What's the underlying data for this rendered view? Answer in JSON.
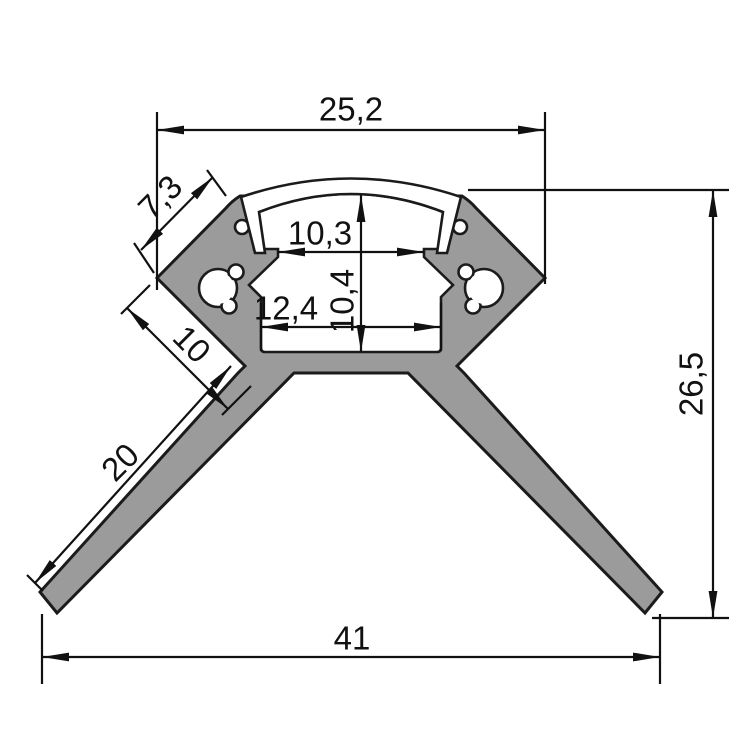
{
  "drawing": {
    "kind": "technical-cross-section",
    "subject": "corner LED aluminium profile with diffuser lens",
    "dimensions": {
      "top_width": "25,2",
      "upper_left_face": "7,3",
      "opening_width": "10,3",
      "channel_height": "10,4",
      "channel_width": "12,4",
      "lower_left_face": "10",
      "flange_length": "20",
      "overall_height": "26,5",
      "overall_width": "41"
    },
    "colors": {
      "body_fill": "#9b9b9b",
      "cavity_fill": "#ffffff",
      "outline": "#1b1b1b",
      "dimension": "#111111",
      "background": "#ffffff"
    }
  }
}
